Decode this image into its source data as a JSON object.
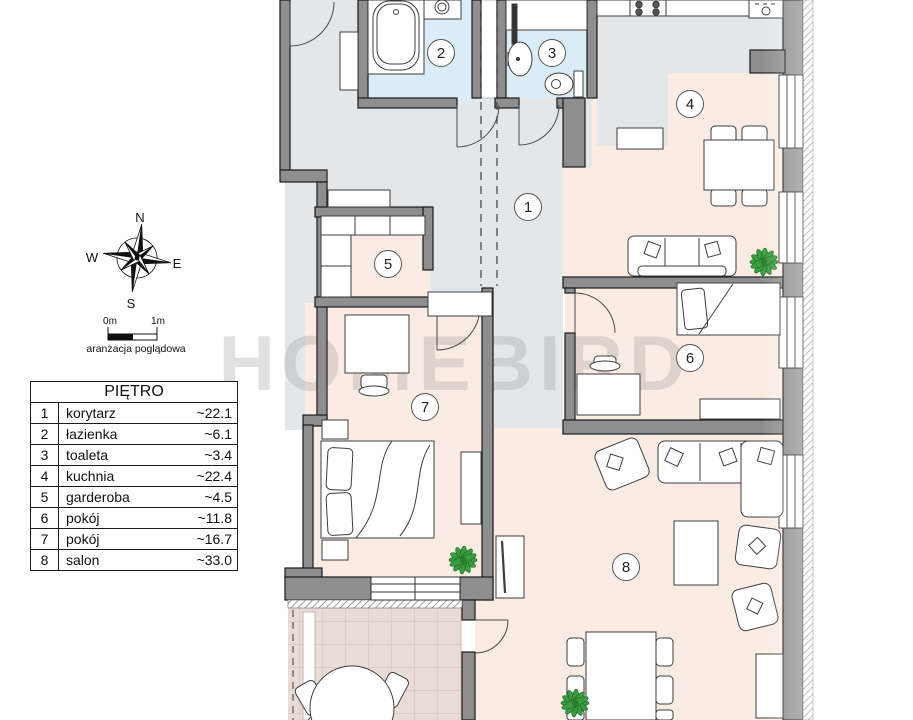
{
  "legend": {
    "title": "PIĘTRO",
    "rows": [
      {
        "num": "1",
        "name": "korytarz",
        "area": "~22.1"
      },
      {
        "num": "2",
        "name": "łazienka",
        "area": "~6.1"
      },
      {
        "num": "3",
        "name": "toaleta",
        "area": "~3.4"
      },
      {
        "num": "4",
        "name": "kuchnia",
        "area": "~22.4"
      },
      {
        "num": "5",
        "name": "garderoba",
        "area": "~4.5"
      },
      {
        "num": "6",
        "name": "pokój",
        "area": "~11.8"
      },
      {
        "num": "7",
        "name": "pokój",
        "area": "~16.7"
      },
      {
        "num": "8",
        "name": "salon",
        "area": "~33.0"
      }
    ]
  },
  "compass": {
    "n": "N",
    "e": "E",
    "s": "S",
    "w": "W"
  },
  "scalebar": {
    "start": "0m",
    "end": "1m",
    "caption": "aranżacja poglądowa"
  },
  "watermark": {
    "text": "HOMEBIRD"
  },
  "plan": {
    "room_labels": [
      {
        "num": "1",
        "room": "korytarz"
      },
      {
        "num": "2",
        "room": "łazienka"
      },
      {
        "num": "3",
        "room": "toaleta"
      },
      {
        "num": "4",
        "room": "kuchnia"
      },
      {
        "num": "5",
        "room": "garderoba"
      },
      {
        "num": "6",
        "room": "pokój"
      },
      {
        "num": "7",
        "room": "pokój"
      },
      {
        "num": "8",
        "room": "salon"
      }
    ]
  },
  "colors": {
    "wall": "#8e8e8e",
    "bath_floor": "#daedf6",
    "room_floor": "#faece2",
    "corridor_floor": "#e4e7ea",
    "terrace_floor": "#e9dcd7",
    "plant_green": "#3a9e40"
  }
}
